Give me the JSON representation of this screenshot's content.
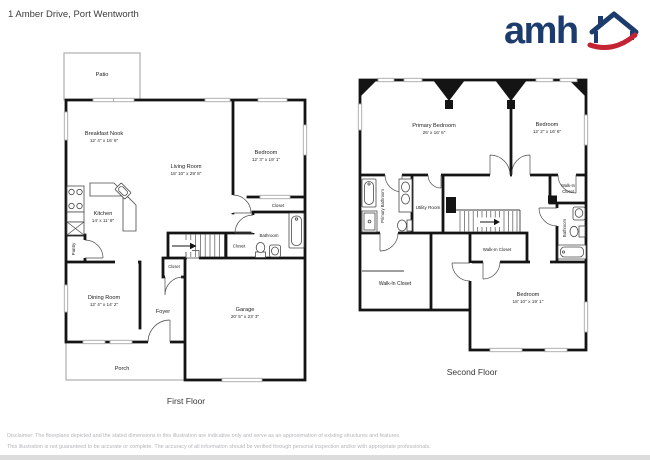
{
  "header": {
    "title": "1 Amber Drive, Port Wentworth",
    "brand": "amh"
  },
  "colors": {
    "brand_navy": "#1d3c6e",
    "brand_red": "#c42333",
    "wall_black": "#141414",
    "window_gray": "#a9a9a9",
    "disclaimer_gray": "#b5b5b9"
  },
  "first_floor": {
    "label": "First Floor",
    "rooms": {
      "patio": {
        "name": "Patio"
      },
      "breakfast_nook": {
        "name": "Breakfast Nook",
        "dims": "12' 4\" x 16' 6\""
      },
      "living_room": {
        "name": "Living Room",
        "dims": "18' 10\" x 29' 8\""
      },
      "bedroom": {
        "name": "Bedroom",
        "dims": "12' 3\" x 19' 1\""
      },
      "kitchen": {
        "name": "Kitchen",
        "dims": "14' x 11' 8\""
      },
      "pantry": {
        "name": "Pantry"
      },
      "closet_bedroom": {
        "name": "Closet"
      },
      "bathroom": {
        "name": "Bathroom"
      },
      "closet_hall": {
        "name": "Closet"
      },
      "closet_foyer": {
        "name": "Closet"
      },
      "dining_room": {
        "name": "Dining Room",
        "dims": "12' 4\" x 14' 2\""
      },
      "foyer": {
        "name": "Foyer"
      },
      "garage": {
        "name": "Garage",
        "dims": "20' 5\" x 23' 3\""
      },
      "porch": {
        "name": "Porch"
      }
    }
  },
  "second_floor": {
    "label": "Second Floor",
    "rooms": {
      "primary_bedroom": {
        "name": "Primary Bedroom",
        "dims": "26' x 16' 6\""
      },
      "bedroom_right": {
        "name": "Bedroom",
        "dims": "12' 2\" x 16' 6\""
      },
      "primary_bathroom": {
        "name": "Primary Bathroom"
      },
      "utility_room": {
        "name": "Utility Room"
      },
      "walk_in_closet_right": {
        "line1": "Walk-In",
        "line2": "Closet"
      },
      "bathroom": {
        "name": "Bathroom"
      },
      "walk_in_closet_mid": {
        "name": "Walk-In Closet"
      },
      "walk_in_closet_left": {
        "name": "Walk-In Closet"
      },
      "bedroom_bottom": {
        "name": "Bedroom",
        "dims": "18' 10\" x 19' 1\""
      }
    }
  },
  "footer": {
    "disclaimer_line1": "Disclaimer: The floorplans depicted and the stated dimensions in this illustration are indicative only and serve as an approximation of existing structures and features.",
    "disclaimer_line2": "This illustration is not guaranteed to be accurate or complete. The accuracy of all information should be verified through personal inspection and/or with appropriate professionals."
  }
}
